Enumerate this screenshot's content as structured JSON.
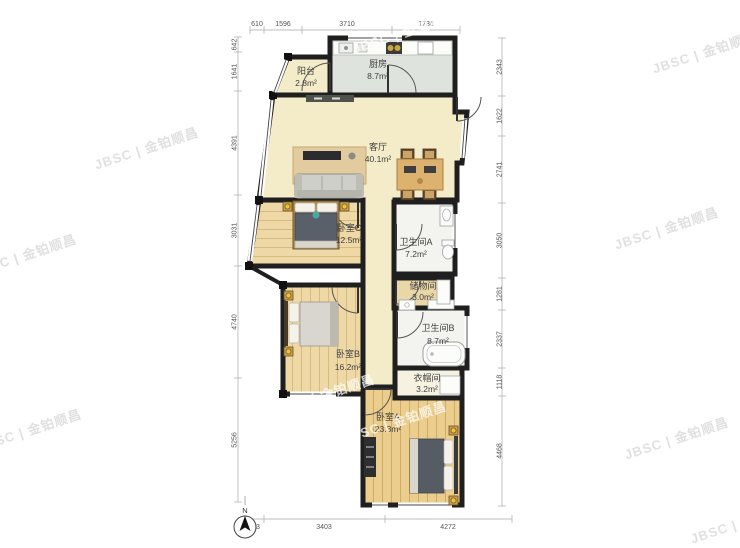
{
  "watermark": {
    "text": "JBSC | 金铂顺昌"
  },
  "compass": {
    "label": "N"
  },
  "rooms": [
    {
      "id": "balcony",
      "name": "阳台",
      "area": "2.8m²"
    },
    {
      "id": "kitchen",
      "name": "厨房",
      "area": "8.7m²"
    },
    {
      "id": "living",
      "name": "客厅",
      "area": "40.1m²"
    },
    {
      "id": "bedroom-c",
      "name": "卧室C",
      "area": "12.5m²"
    },
    {
      "id": "bath-a",
      "name": "卫生间A",
      "area": "7.2m²"
    },
    {
      "id": "storage",
      "name": "储物间",
      "area": "3.0m²"
    },
    {
      "id": "bedroom-b",
      "name": "卧室B",
      "area": "16.2m²"
    },
    {
      "id": "bath-b",
      "name": "卫生间B",
      "area": "8.7m²"
    },
    {
      "id": "cloak",
      "name": "衣帽间",
      "area": "3.2m²"
    },
    {
      "id": "bedroom-a",
      "name": "卧室A",
      "area": "23.3m²"
    }
  ],
  "dimensions": {
    "top": [
      "610",
      "1596",
      "3710",
      "1736"
    ],
    "left": [
      "642",
      "1641",
      "4391",
      "3031",
      "4740",
      "5256"
    ],
    "right": [
      "2343",
      "1622",
      "2741",
      "3050",
      "1281",
      "2337",
      "1118",
      "4468"
    ],
    "bottom": [
      "793",
      "3403",
      "4272"
    ]
  },
  "colors": {
    "wall": "#1f1f1f",
    "floor_living": "#f4ebc9",
    "floor_kitchen": "#dfe3dd",
    "floor_bedroom": "#eed9a6",
    "floor_bath": "#f3f3ef",
    "accent_lamp": "#ecc43c"
  }
}
